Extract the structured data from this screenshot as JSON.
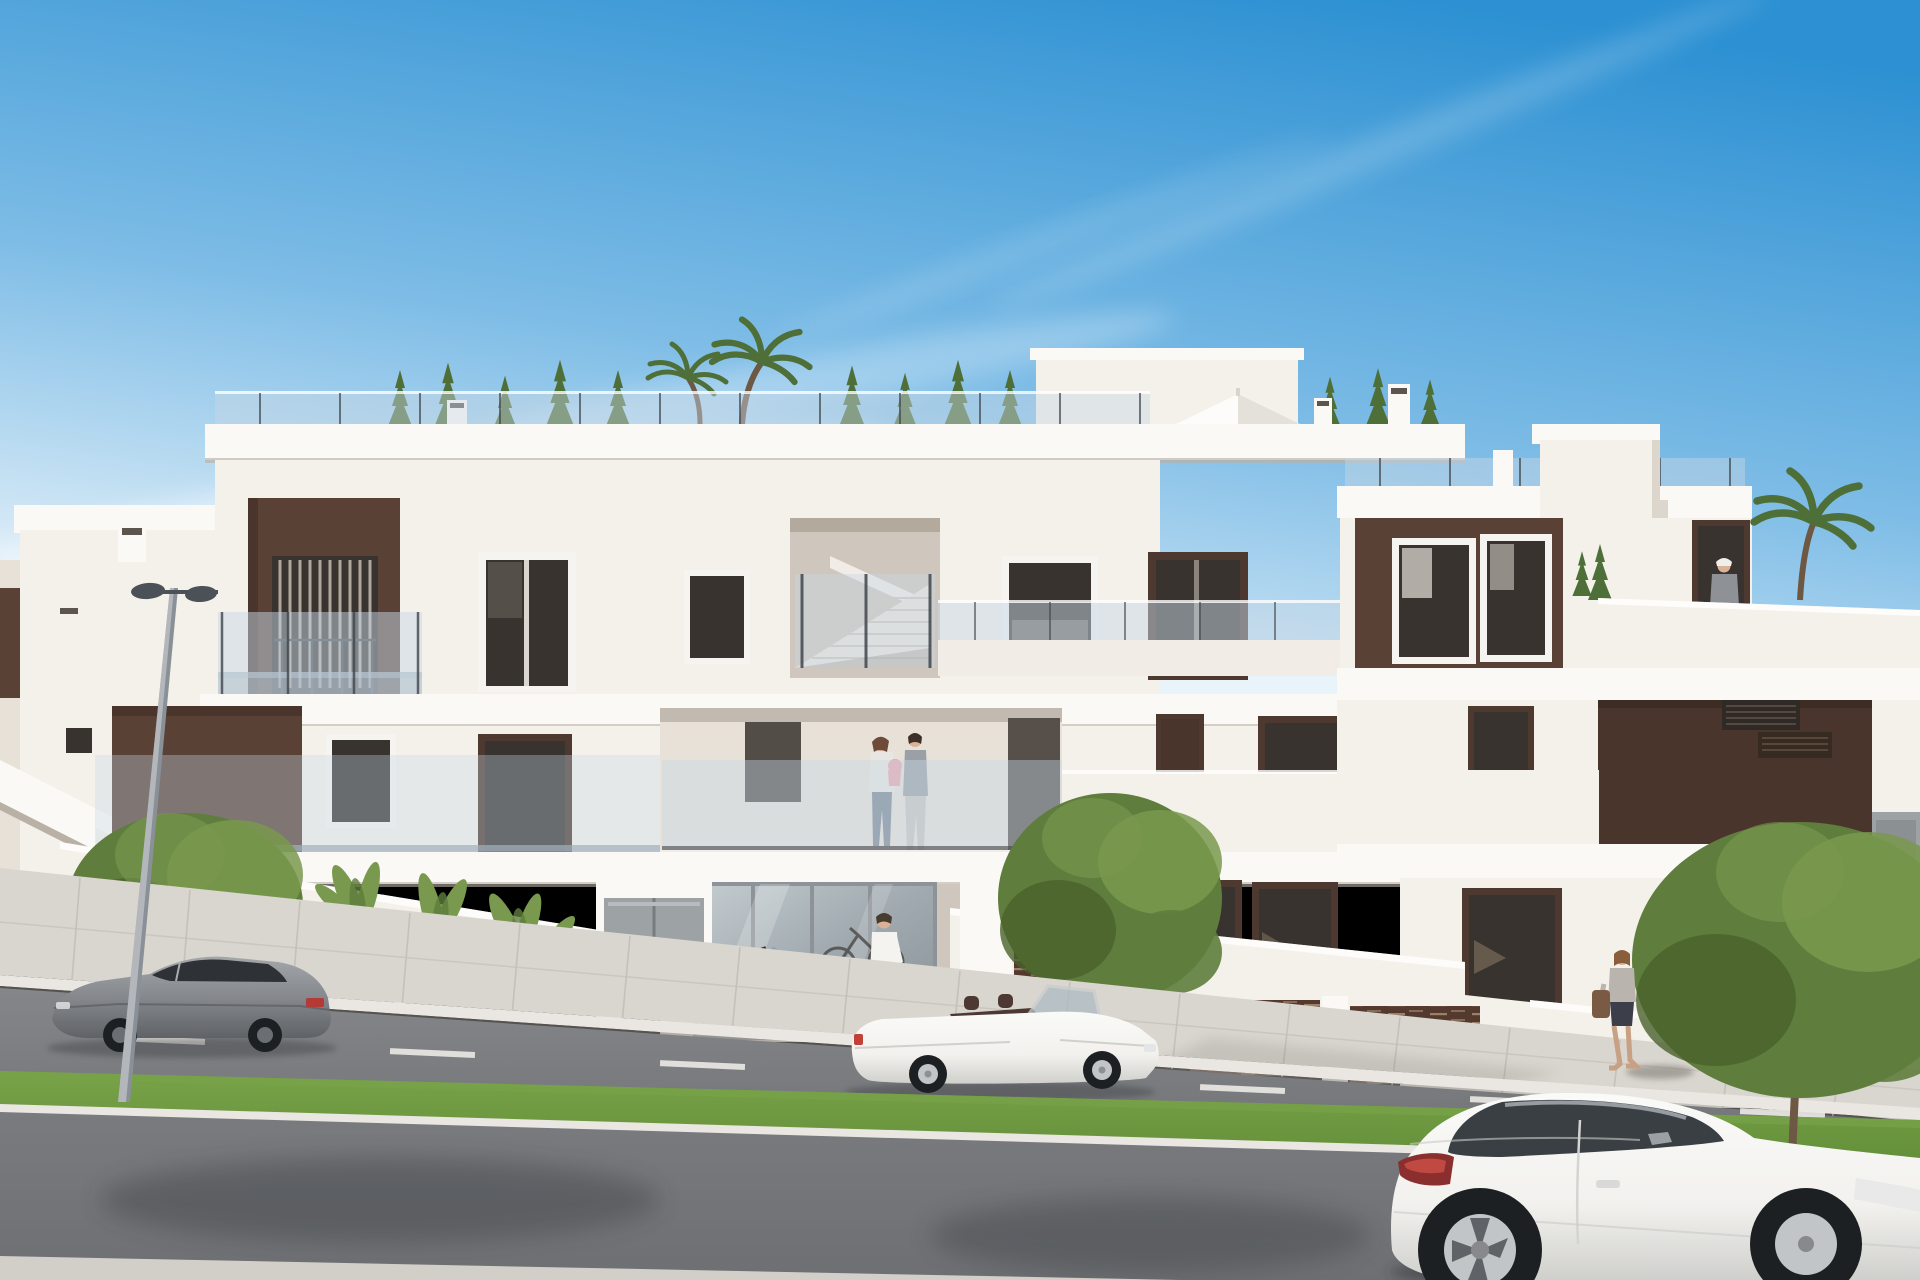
{
  "scene": {
    "type": "architectural-render",
    "description": "Street-view render of a new-build modern white apartment complex with brown feature panels, glass balcony balustrades, central open staircase, rooftop terraces with planting, parked cars and pedestrians under a clear blue sky",
    "palette": {
      "sky-top": "#2c90d2",
      "sky-mid": "#7dbce6",
      "sky-horizon": "#e9f3fa",
      "cloud": "#ffffff",
      "facade": "#f4f1ea",
      "facade-bright": "#fbf9f5",
      "facade-shade": "#e7e1d8",
      "recess": "#cfc7bd",
      "recess-dark": "#b3a99d",
      "accent": "#5a4136",
      "accent-dark": "#4a352c",
      "window-glass": "#38332e",
      "window-frame": "#f6f4f0",
      "frame-brown": "#4e3930",
      "glass-rail": "#c7d8e5",
      "rail-post": "#41464b",
      "road": "#84868a",
      "road-near": "#797b7f",
      "dash": "#eceae6",
      "sidewalk": "#d9d5cf",
      "sidewalk-joint": "#c2bdb5",
      "curb": "#eae7e2",
      "grass": "#648f3a",
      "grass-light": "#78a348",
      "canopy": "#5f7d3c",
      "canopy-dark": "#48622c",
      "canopy-light": "#79994e",
      "conifer": "#4f6f38",
      "trunk": "#6d5844",
      "fence": "#53392e",
      "fence-light": "#a88e73",
      "cabinet": "#9da2a5",
      "sticker": "#e4c83d",
      "car-gray": "#85888d",
      "car-gray-dark": "#5f6267",
      "car-white": "#f2f1ee",
      "tire": "#1d2023",
      "rim": "#c2c5c7",
      "lamp": "#4a5258",
      "skin": "#d9b298"
    },
    "building": {
      "name": "modern-apartment-block",
      "floors": 3,
      "features": [
        "flat roof terraces with glass railings",
        "rooftop conifers and palm trees",
        "white roof parasol",
        "brown feature panels",
        "glass balustrade balconies",
        "central open staircase bay",
        "ground-floor entrance with glass doors",
        "slatted brown garden fences",
        "white chimney stacks"
      ]
    },
    "vehicles": [
      {
        "name": "grey sports coupe parked facing left",
        "color": "#85888d"
      },
      {
        "name": "white convertible roadster parked facing right",
        "color": "#f2f1ee"
      },
      {
        "name": "white coupe in foreground facing right",
        "color": "#f2f1ee"
      }
    ],
    "people": [
      {
        "name": "couple with baby on first-floor balcony"
      },
      {
        "name": "man walking to entrance carrying bag"
      },
      {
        "name": "man climbing stair to roof terrace"
      },
      {
        "name": "woman standing on roof terrace"
      },
      {
        "name": "woman walking on right sidewalk with handbag"
      }
    ],
    "vegetation": [
      {
        "name": "street tree left"
      },
      {
        "name": "street tree centre"
      },
      {
        "name": "street tree right"
      },
      {
        "name": "banana plants behind left garden wall"
      },
      {
        "name": "palm bush right garden wall"
      },
      {
        "name": "rooftop conifer row"
      },
      {
        "name": "rooftop palms"
      }
    ],
    "street_objects": [
      {
        "name": "double-head street lamp"
      },
      {
        "name": "blue bicycle and grey bicycle at entrance"
      },
      {
        "name": "grey utility cabinets with yellow warning stickers"
      },
      {
        "name": "road with white dashed centre line"
      },
      {
        "name": "grass median strip"
      }
    ]
  }
}
